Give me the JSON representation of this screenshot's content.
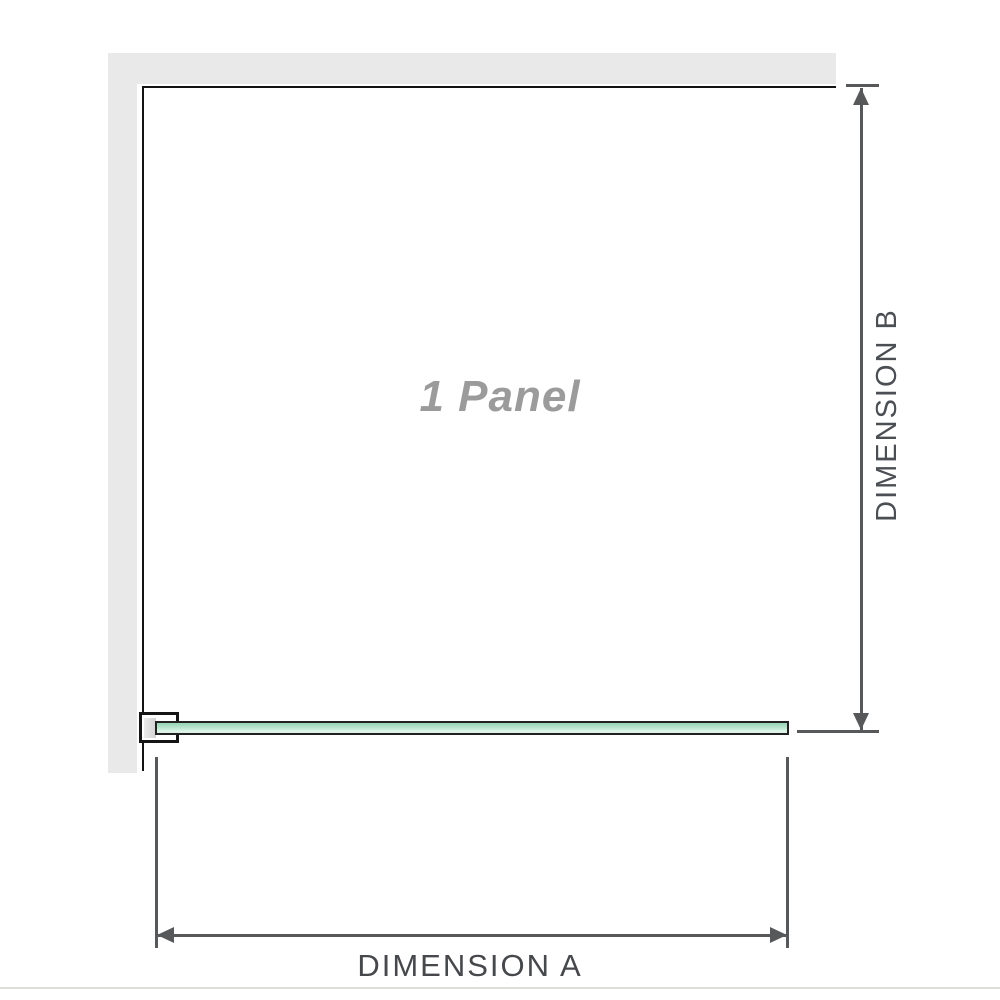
{
  "diagram": {
    "title_watermark": "1 Panel",
    "dimension_a": {
      "label": "DIMENSION A",
      "orientation": "horizontal"
    },
    "dimension_b": {
      "label": "DIMENSION B",
      "orientation": "vertical"
    },
    "components": {
      "wall": "l-shaped-wall",
      "panel_front_outline": "open-square",
      "glass_panel_plan_view": "green-bar",
      "wall_bracket": "u-clamp"
    },
    "colors": {
      "wall_fill": "#e9e9ea",
      "panel_outline": "#141414",
      "glass_fill_top": "#96d4b4",
      "glass_fill_bottom": "#e3f6ec",
      "glass_border": "#222222",
      "dimension_lines": "#57585a",
      "dimension_text": "#46484b",
      "watermark_text": "#9b9b9b",
      "baseline_rule": "#dbded9",
      "background": "#ffffff"
    }
  }
}
